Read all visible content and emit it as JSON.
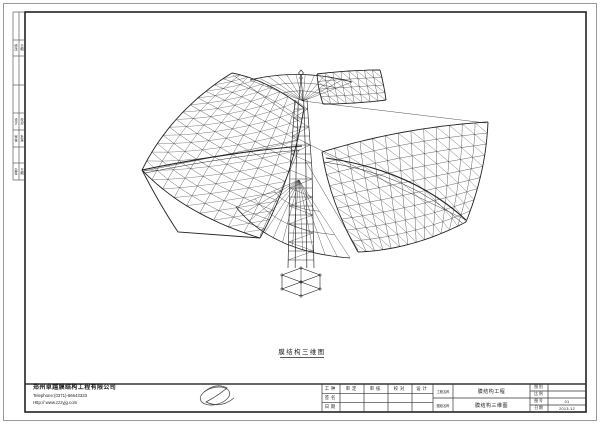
{
  "caption": {
    "text": "膜结构三维图"
  },
  "company": {
    "name": "郑州卓越膜结构工程有限公司",
    "phone": "Telephone:(0371)-66643333",
    "website": "Http:// www.zzzyjg.com"
  },
  "margin_table": {
    "cells": [
      "修改",
      "日期",
      "设计",
      "校对",
      "审核",
      "批准",
      "会签",
      "日期"
    ]
  },
  "title_block": {
    "col_labels": [
      "工种",
      "签名",
      "日期"
    ],
    "headers": [
      "审定",
      "审核",
      "校对",
      "设计"
    ],
    "project_label": "工程名称",
    "project_value": "膜结构工程",
    "sheet_label": "图纸名称",
    "sheet_value": "膜结构三维图",
    "right_rows": [
      {
        "label": "图别",
        "value": ""
      },
      {
        "label": "比例",
        "value": ""
      },
      {
        "label": "图号",
        "value": "01"
      },
      {
        "label": "日期",
        "value": "2013-12"
      }
    ]
  },
  "colors": {
    "line": "#232323",
    "frame": "#222222",
    "outer_border": "#9a9a9a"
  },
  "drawing": {
    "stroke": "#232323",
    "patches": [
      {
        "name": "left-wing",
        "quad": [
          [
            142,
            170
          ],
          [
            232,
            73
          ],
          [
            304,
            108
          ],
          [
            260,
            238
          ]
        ],
        "ctrl": [
          [
            172,
            110
          ],
          [
            268,
            80
          ],
          [
            292,
            180
          ],
          [
            185,
            215
          ]
        ],
        "nu": 13,
        "nv": 9
      },
      {
        "name": "right-wing",
        "quad": [
          [
            322,
            152
          ],
          [
            488,
            122
          ],
          [
            466,
            222
          ],
          [
            358,
            252
          ]
        ],
        "ctrl": [
          [
            404,
            127
          ],
          [
            486,
            172
          ],
          [
            412,
            250
          ],
          [
            330,
            203
          ]
        ],
        "nu": 13,
        "nv": 9
      },
      {
        "name": "top-right-panel",
        "quad": [
          [
            317,
            74
          ],
          [
            380,
            70
          ],
          [
            386,
            100
          ],
          [
            323,
            104
          ]
        ],
        "ctrl": [
          [
            349,
            70
          ],
          [
            384,
            85
          ],
          [
            354,
            104
          ],
          [
            318,
            89
          ]
        ],
        "nu": 8,
        "nv": 4
      }
    ],
    "fans": [
      {
        "name": "top-fan",
        "apex": [
          303,
          101
        ],
        "chord": [
          [
            250,
            80
          ],
          [
            300,
            68
          ],
          [
            352,
            82
          ]
        ],
        "rays": 12,
        "arcs": [
          0.38,
          0.68,
          1
        ]
      },
      {
        "name": "bottom-fan",
        "apex": [
          299,
          180
        ],
        "chord": [
          [
            236,
            207
          ],
          [
            272,
            252
          ],
          [
            350,
            258
          ]
        ],
        "rays": 13,
        "arcs": [
          0.4,
          0.7,
          1
        ]
      }
    ],
    "curves": [
      {
        "d": "M142,170 Q230,152 302,146",
        "w": 1.1
      },
      {
        "d": "M145,173 Q230,156 300,150",
        "w": 0.5
      },
      {
        "d": "M326,158 Q412,170 466,220",
        "w": 1.1
      },
      {
        "d": "M324,162 Q410,174 462,223",
        "w": 0.5
      },
      {
        "d": "M142,170 Q160,205 178,232 L260,238",
        "w": 0.9
      }
    ],
    "cables": [
      [
        [
          303,
          101
        ],
        [
          486,
          123
        ]
      ],
      [
        [
          304,
          142
        ],
        [
          466,
          220
        ]
      ],
      [
        [
          298,
          140
        ],
        [
          144,
          171
        ]
      ],
      [
        [
          299,
          150
        ],
        [
          260,
          236
        ]
      ],
      [
        [
          297,
          120
        ],
        [
          233,
          75
        ]
      ],
      [
        [
          305,
          160
        ],
        [
          358,
          250
        ]
      ]
    ],
    "mast": {
      "cx": 301,
      "spire_top": 72,
      "top": 100,
      "mid": 170,
      "base": 268,
      "foot": 296,
      "hw_top": 6,
      "hw_mid": 11,
      "hw_base": 13,
      "step": 9
    }
  }
}
